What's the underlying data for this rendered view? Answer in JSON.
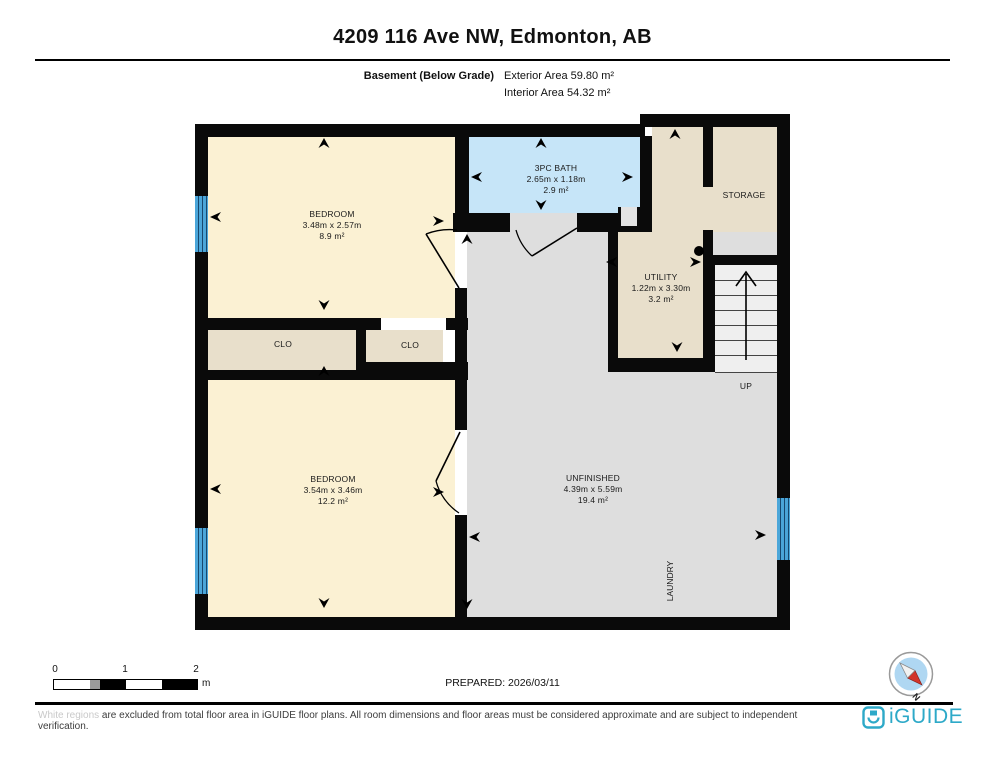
{
  "header": {
    "title": "4209 116 Ave NW, Edmonton, AB",
    "floor_label": "Basement (Below Grade)",
    "exterior_area": "Exterior Area 59.80 m²",
    "interior_area": "Interior Area 54.32 m²"
  },
  "plan": {
    "rooms": {
      "bedroom1": {
        "name": "BEDROOM",
        "dims": "3.48m x 2.57m",
        "area": "8.9 m²"
      },
      "bath": {
        "name": "3PC BATH",
        "dims": "2.65m x 1.18m",
        "area": "2.9 m²"
      },
      "storage": {
        "name": "STORAGE"
      },
      "utility": {
        "name": "UTILITY",
        "dims": "1.22m x 3.30m",
        "area": "3.2 m²"
      },
      "clo_left": {
        "name": "CLO"
      },
      "clo_right": {
        "name": "CLO"
      },
      "bedroom2": {
        "name": "BEDROOM",
        "dims": "3.54m x 3.46m",
        "area": "12.2 m²"
      },
      "unfinished": {
        "name": "UNFINISHED",
        "dims": "4.39m x 5.59m",
        "area": "19.4 m²"
      },
      "laundry": {
        "name": "LAUNDRY"
      }
    },
    "stairs_label": "UP"
  },
  "footer": {
    "scale": {
      "tick0": "0",
      "tick1": "1",
      "tick2": "2",
      "unit": "m"
    },
    "prepared": "PREPARED: 2026/03/11",
    "compass_label": "N",
    "disclaimer_light": "White regions",
    "disclaimer_rest": " are excluded from total floor area in iGUIDE floor plans. All room dimensions and floor areas must be considered approximate and are subject to independent verification.",
    "brand": "iGUIDE"
  },
  "colors": {
    "brand_teal": "#2DA9C8",
    "wall_black": "#0A0A0A",
    "bedroom_fill": "#FBF1D3",
    "bath_fill": "#C6E5F8",
    "storage_fill": "#E8DFCB",
    "unfinished_fill": "#DEDEDE",
    "window_blue": "#4BA6D9",
    "compass_red": "#D2342A"
  }
}
